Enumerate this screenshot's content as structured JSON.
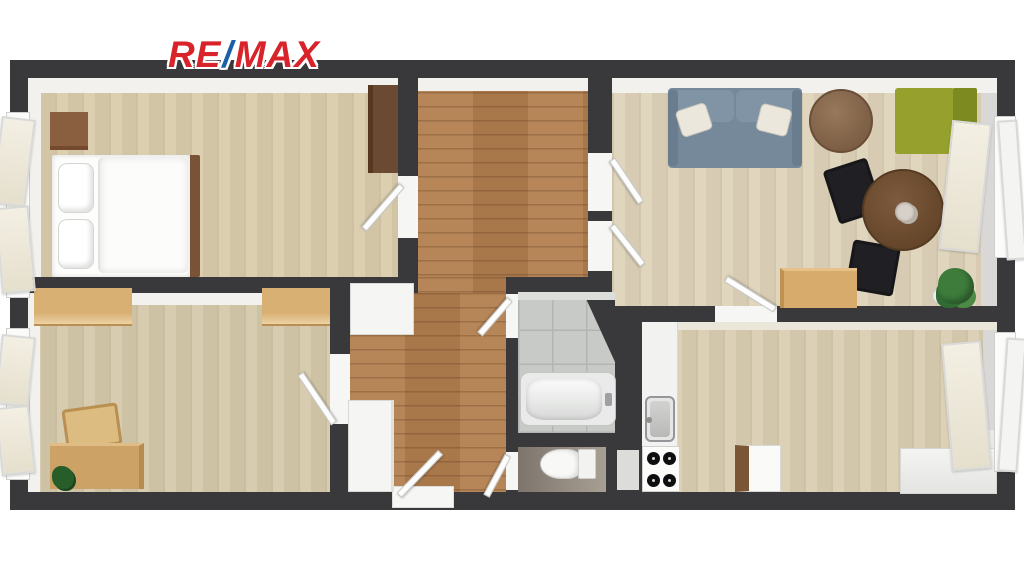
{
  "logo": {
    "re": "RE",
    "slash": "/",
    "max": "MAX",
    "brand_red": "#d8232a",
    "brand_blue": "#1b5fa8"
  },
  "plan": {
    "type": "apartment-floor-plan-top-view",
    "wall_color": "#39383a",
    "rooms": [
      {
        "id": "bedroom",
        "floor_color": "#d9cbaa",
        "furniture": [
          "double-bed",
          "two-pillows",
          "nightstand",
          "wardrobe",
          "open-window",
          "door"
        ]
      },
      {
        "id": "living-room",
        "floor_color": "#ded3b9",
        "furniture": [
          "blue-sofa",
          "two-cushions",
          "round-coffee-table",
          "green-armchair",
          "round-dining-table",
          "two-black-chairs",
          "oak-desk",
          "potted-plant",
          "open-window",
          "two-doors"
        ]
      },
      {
        "id": "study-room",
        "floor_color": "#d4c8a9",
        "furniture": [
          "oak-desk",
          "wooden-chair",
          "small-plant",
          "wall-cabinet",
          "wall-cabinet",
          "open-window",
          "door"
        ]
      },
      {
        "id": "hallway",
        "floor_color": "#b27e4e",
        "furniture": [
          "white-closet",
          "white-closet",
          "entrance-door",
          "doormat"
        ]
      },
      {
        "id": "bathroom",
        "floor_color": "#c8cac8",
        "furniture": [
          "bathtub",
          "door"
        ]
      },
      {
        "id": "wc",
        "floor_color": "#8a8078",
        "furniture": [
          "toilet",
          "door"
        ]
      },
      {
        "id": "kitchen",
        "floor_color": "#d9cdb0",
        "furniture": [
          "counter-run",
          "sink",
          "stove-four-burners",
          "small-cabinet",
          "corner-counter",
          "open-window"
        ]
      }
    ]
  }
}
